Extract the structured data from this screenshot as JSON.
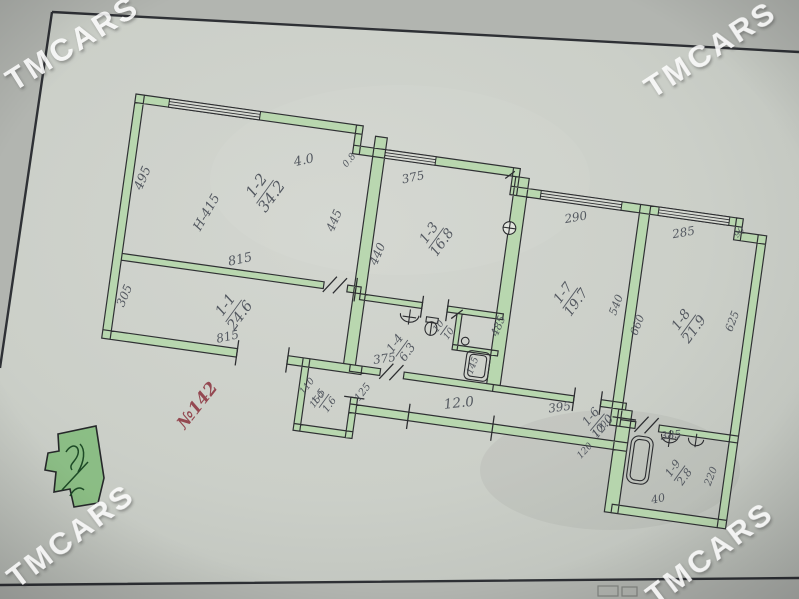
{
  "watermark": "TMCARS",
  "apartment_number": "№142",
  "rooms": [
    {
      "number": "1-2",
      "area": "34.2"
    },
    {
      "number": "1-1",
      "area": "24.6"
    },
    {
      "number": "1-3",
      "area": "16.8"
    },
    {
      "number": "1-4",
      "area": "6.3"
    },
    {
      "number": "1-5",
      "area": "1.6"
    },
    {
      "number": "1-6",
      "area": "12.0"
    },
    {
      "number": "1-7",
      "area": "19.7"
    },
    {
      "number": "1-8",
      "area": "21.9"
    },
    {
      "number": "1-9",
      "area": "2.8"
    },
    {
      "number": "10",
      "area": "10"
    }
  ],
  "dimensions": [
    "495",
    "H-415",
    "4.0",
    "0.8",
    "445",
    "815",
    "305",
    "815",
    "375",
    "440",
    "290",
    "485",
    "540",
    "285",
    "90",
    "625",
    "660",
    "395",
    "100",
    "120",
    "12.0",
    "125",
    "110",
    "150",
    "375",
    "145",
    "385",
    "220",
    "40"
  ],
  "colors": {
    "wall_highlight": "#b5d7ab",
    "paper": "#ccd0c9",
    "ink": "#2c2d30",
    "pencil": "#4a4f58",
    "stamp_green": "#84bb7d",
    "number_red": "#8e3a44"
  }
}
